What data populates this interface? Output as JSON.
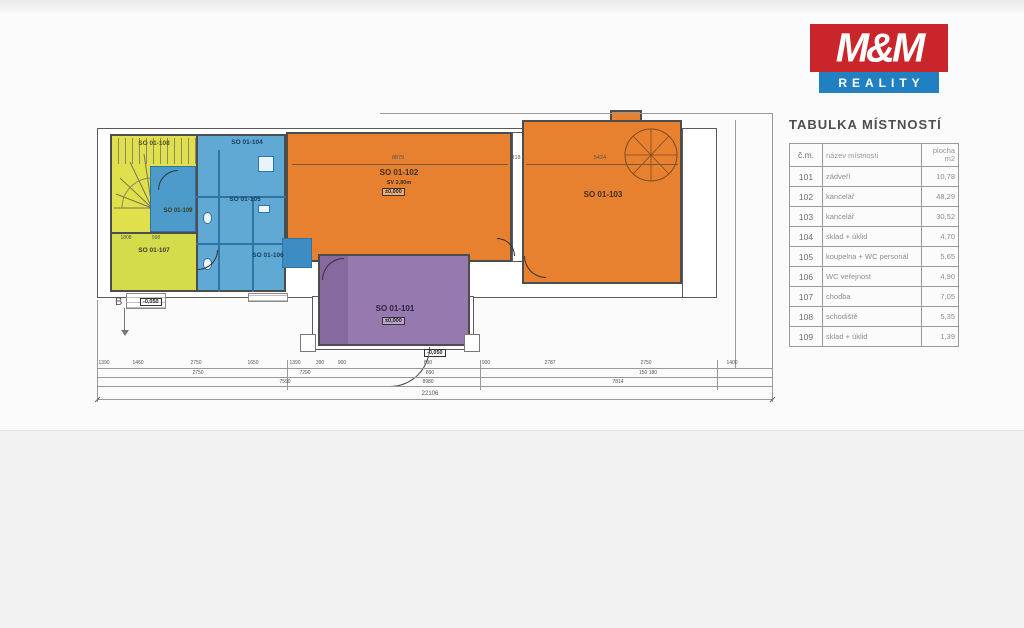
{
  "logo": {
    "name": "M&M",
    "subtitle": "REALITY",
    "red": "#c9252b",
    "blue": "#2180c2"
  },
  "room_table": {
    "title": "TABULKA MÍSTNOSTÍ",
    "headers": {
      "num": "č.m.",
      "name": "název místnosti",
      "area": "plocha\nm2"
    },
    "rows": [
      {
        "num": "101",
        "name": "zádveří",
        "area": "10,78"
      },
      {
        "num": "102",
        "name": "kancelář",
        "area": "48,29"
      },
      {
        "num": "103",
        "name": "kancelář",
        "area": "30,52"
      },
      {
        "num": "104",
        "name": "sklad + úklid",
        "area": "4,70"
      },
      {
        "num": "105",
        "name": "koupelna + WC personál",
        "area": "5,65"
      },
      {
        "num": "106",
        "name": "WC veřejnost",
        "area": "4,90"
      },
      {
        "num": "107",
        "name": "chodba",
        "area": "7,05"
      },
      {
        "num": "108",
        "name": "schodiště",
        "area": "5,35"
      },
      {
        "num": "109",
        "name": "sklad + úklid",
        "area": "1,39"
      }
    ]
  },
  "plan": {
    "rooms": {
      "r101": {
        "label": "SO 01-101",
        "level": "±0,000"
      },
      "r102": {
        "label": "SO 01-102",
        "height_note": "SV 2,80m",
        "level": "±0,000"
      },
      "r103": {
        "label": "SO 01-103"
      },
      "r104": {
        "label": "SO 01-104"
      },
      "r105": {
        "label": "SO 01-105"
      },
      "r106": {
        "label": "SO 01-106"
      },
      "r107": {
        "label": "SO 01-107"
      },
      "r108": {
        "label": "SO 01-108"
      },
      "r109": {
        "label": "SO 01-109"
      }
    },
    "marks": {
      "section": "B",
      "entry_level": "-0,050"
    },
    "dims": {
      "top": [
        "8879",
        "818",
        "5424"
      ],
      "tier1": [
        "1390",
        "1460",
        "2750",
        "1650",
        "1390",
        "390",
        "900",
        "890",
        "900",
        "2787",
        "2750",
        "1400"
      ],
      "tier2": [
        "2750",
        "7290",
        "890",
        "150 180"
      ],
      "tier3": [
        "7590",
        "8980",
        "7814"
      ],
      "total": "22106",
      "left": [
        "1808",
        "998"
      ]
    },
    "colors": {
      "yellow": "#e0e04d",
      "yellow_green": "#d4dc4c",
      "blue": "#61a9d5",
      "blue_dark": "#3e8dc2",
      "orange": "#e8812f",
      "purple": "#9579af"
    }
  }
}
